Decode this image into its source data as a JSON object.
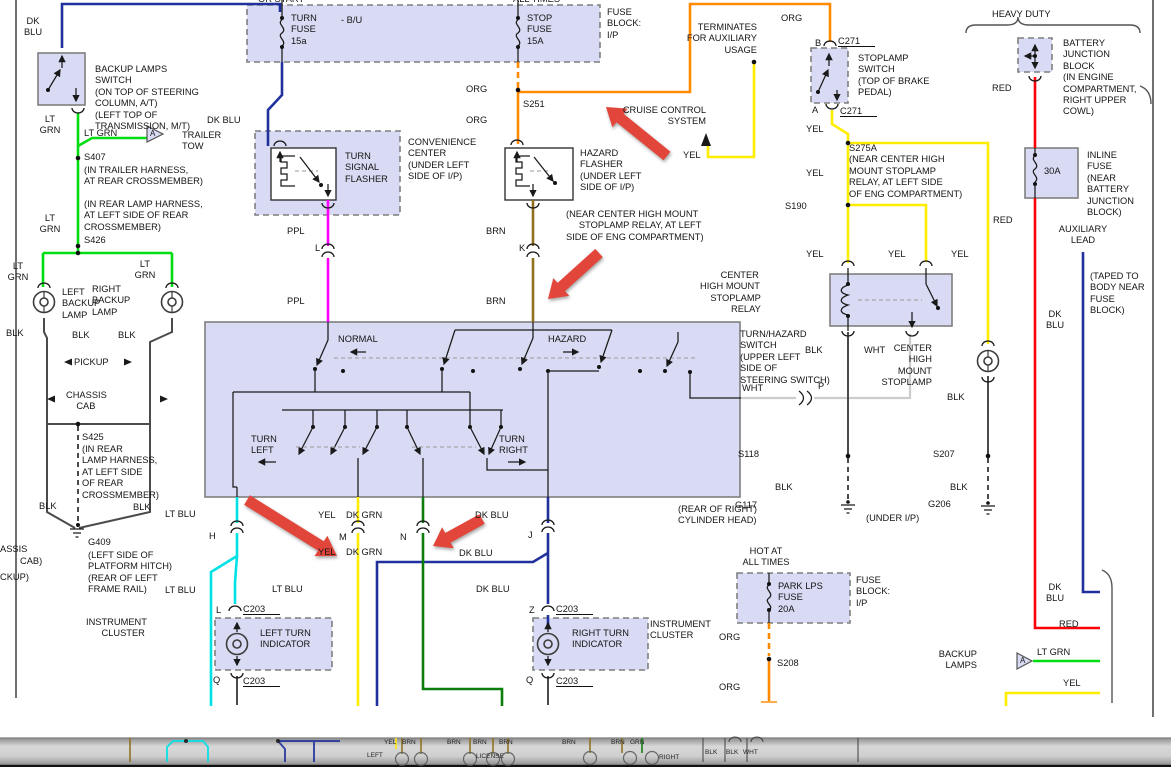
{
  "palette": {
    "dkblu": "#20309c",
    "ltgrn": "#00dd11",
    "org": "#ff8a00",
    "yel": "#ffed00",
    "ppl": "#ff00ff",
    "brn": "#8f701f",
    "ltblu": "#00e2e6",
    "dkgrn": "#0a7d0a",
    "red": "#fb0006",
    "blkwire": "#4b4b4b",
    "whtwire": "#cccccc",
    "lavender": "#d9daf3",
    "boxborder": "#7f7f7f",
    "arrowred": "#e2453a"
  },
  "labels": [
    {
      "n": "hot-in-run-fragment",
      "t": "OR START",
      "x": 258,
      "y": -6
    },
    {
      "n": "hot-at-all-times-fragment",
      "t": "ALL TIMES",
      "x": 513,
      "y": -6
    },
    {
      "n": "fuse-block-ip-label",
      "t": "FUSE\nBLOCK:\nI/P",
      "x": 607,
      "y": 7
    },
    {
      "n": "turn-fuse-label",
      "t": "TURN\nFUSE\n15a",
      "x": 291,
      "y": 13
    },
    {
      "n": "bu-tap-label",
      "t": "- B/U",
      "x": 341,
      "y": 15
    },
    {
      "n": "stop-fuse-label",
      "t": "STOP\nFUSE\n15A",
      "x": 527,
      "y": 13
    },
    {
      "n": "dk-blu-label-1",
      "t": "DK\nBLU",
      "x": 18,
      "y": 16,
      "w": 30,
      "al": "c"
    },
    {
      "n": "backup-lamps-switch-label",
      "t": "BACKUP LAMPS\nSWITCH\n(ON TOP OF STEERING\nCOLUMN, A/T)\n(LEFT TOP OF\nTRANSMISSION, M/T)",
      "x": 95,
      "y": 64
    },
    {
      "n": "lt-grn-label-1",
      "t": "LT\nGRN",
      "x": 32,
      "y": 114,
      "w": 36,
      "al": "c"
    },
    {
      "n": "lt-grn-label-2",
      "t": "LT GRN",
      "x": 84,
      "y": 128
    },
    {
      "n": "dk-blu-label-2",
      "t": "DK BLU",
      "x": 207,
      "y": 115
    },
    {
      "n": "trailer-tow-label",
      "t": "TRAILER\nTOW",
      "x": 182,
      "y": 130
    },
    {
      "n": "s407-label",
      "t": "S407",
      "x": 84,
      "y": 152
    },
    {
      "n": "s407-note",
      "t": "(IN TRAILER HARNESS,\nAT REAR CROSSMEMBER)",
      "x": 84,
      "y": 165
    },
    {
      "n": "s426-note",
      "t": "(IN REAR LAMP HARNESS,\nAT LEFT SIDE OF REAR\nCROSSMEMBER)",
      "x": 84,
      "y": 199
    },
    {
      "n": "lt-grn-label-3",
      "t": "LT\nGRN",
      "x": 32,
      "y": 213,
      "w": 36,
      "al": "c"
    },
    {
      "n": "s426-label",
      "t": "S426",
      "x": 84,
      "y": 235
    },
    {
      "n": "lt-grn-label-4",
      "t": "LT\nGRN",
      "x": 0,
      "y": 261,
      "w": 36,
      "al": "c"
    },
    {
      "n": "lt-grn-label-5",
      "t": "LT\nGRN",
      "x": 127,
      "y": 259,
      "w": 36,
      "al": "c"
    },
    {
      "n": "left-backup-lamp-label",
      "t": "LEFT\nBACKUP\nLAMP",
      "x": 62,
      "y": 287
    },
    {
      "n": "right-backup-lamp-label",
      "t": "RIGHT\nBACKUP\nLAMP",
      "x": 92,
      "y": 284
    },
    {
      "n": "blk-label-1",
      "t": "BLK",
      "x": 6,
      "y": 328
    },
    {
      "n": "blk-label-2",
      "t": "BLK",
      "x": 72,
      "y": 330
    },
    {
      "n": "blk-label-3",
      "t": "BLK",
      "x": 118,
      "y": 330
    },
    {
      "n": "pickup-label",
      "t": "PICKUP",
      "x": 74,
      "y": 357
    },
    {
      "n": "chassis-cab-label",
      "t": "CHASSIS\n    CAB",
      "x": 66,
      "y": 390
    },
    {
      "n": "s425-label",
      "t": "S425",
      "x": 82,
      "y": 432
    },
    {
      "n": "s425-note",
      "t": "(IN REAR\nLAMP HARNESS,\nAT LEFT SIDE\nOF REAR\nCROSSMEMBER)",
      "x": 82,
      "y": 444
    },
    {
      "n": "blk-label-4",
      "t": "BLK",
      "x": 39,
      "y": 501
    },
    {
      "n": "blk-label-5",
      "t": "BLK",
      "x": 133,
      "y": 502
    },
    {
      "n": "lt-blu-label-1",
      "t": "LT BLU",
      "x": 165,
      "y": 509
    },
    {
      "n": "chassis-fragment",
      "t": "ASSIS",
      "x": 0,
      "y": 544
    },
    {
      "n": "cab-fragment",
      "t": "CAB)",
      "x": 20,
      "y": 556
    },
    {
      "n": "pickup-fragment",
      "t": "CKUP)",
      "x": 0,
      "y": 572
    },
    {
      "n": "g409-label",
      "t": "G409",
      "x": 88,
      "y": 537
    },
    {
      "n": "g409-note",
      "t": "(LEFT SIDE OF\nPLATFORM HITCH)\n(REAR OF LEFT\nFRAME RAIL)",
      "x": 88,
      "y": 550
    },
    {
      "n": "lt-blu-label-2",
      "t": "LT BLU",
      "x": 165,
      "y": 585
    },
    {
      "n": "instrument-cluster-left-label",
      "t": "INSTRUMENT\n      CLUSTER",
      "x": 86,
      "y": 617
    },
    {
      "n": "convenience-center-label",
      "t": "CONVENIENCE\nCENTER\n(UNDER LEFT\nSIDE OF I/P)",
      "x": 408,
      "y": 137
    },
    {
      "n": "turn-signal-flasher-label",
      "t": "TURN\nSIGNAL\nFLASHER",
      "x": 345,
      "y": 151
    },
    {
      "n": "ppl-label-1",
      "t": "PPL",
      "x": 287,
      "y": 226
    },
    {
      "n": "connector-l-label",
      "t": "L",
      "x": 315,
      "y": 243
    },
    {
      "n": "ppl-label-2",
      "t": "PPL",
      "x": 287,
      "y": 296
    },
    {
      "n": "hazard-flasher-label",
      "t": "HAZARD\nFLASHER\n(UNDER LEFT\nSIDE OF I/P)",
      "x": 580,
      "y": 148
    },
    {
      "n": "brn-label-1",
      "t": "BRN",
      "x": 486,
      "y": 226
    },
    {
      "n": "connector-k-label",
      "t": "K",
      "x": 519,
      "y": 243
    },
    {
      "n": "brn-label-2",
      "t": "BRN",
      "x": 486,
      "y": 296
    },
    {
      "n": "chm-relay-location-note",
      "t": "(NEAR CENTER HIGH MOUNT\n     STOPLAMP RELAY, AT LEFT\nSIDE OF ENG COMPARTMENT)",
      "x": 566,
      "y": 209
    },
    {
      "n": "org-label-1",
      "t": "ORG",
      "x": 466,
      "y": 84
    },
    {
      "n": "s251-label",
      "t": "S251",
      "x": 523,
      "y": 99
    },
    {
      "n": "org-label-2",
      "t": "ORG",
      "x": 466,
      "y": 115
    },
    {
      "n": "cruise-control-label",
      "t": "CRUISE CONTROL\nSYSTEM",
      "x": 616,
      "y": 105,
      "w": 90,
      "al": "r"
    },
    {
      "n": "yel-label-cruise",
      "t": "YEL",
      "x": 683,
      "y": 150
    },
    {
      "n": "terminates-label",
      "t": "TERMINATES\nFOR AUXILIARY\nUSAGE",
      "x": 657,
      "y": 22,
      "w": 100,
      "al": "r"
    },
    {
      "n": "org-label-3",
      "t": "ORG",
      "x": 781,
      "y": 13
    },
    {
      "n": "connector-b-label",
      "t": "B",
      "x": 815,
      "y": 38
    },
    {
      "n": "c271-top-label",
      "t": "C271",
      "x": 838,
      "y": 36,
      "u": 1
    },
    {
      "n": "stoplamp-switch-label",
      "t": "STOPLAMP\nSWITCH\n(TOP OF BRAKE\nPEDAL)",
      "x": 858,
      "y": 53
    },
    {
      "n": "connector-a-label",
      "t": "A",
      "x": 812,
      "y": 105
    },
    {
      "n": "c271-bottom-label",
      "t": "C271",
      "x": 840,
      "y": 106,
      "u": 1
    },
    {
      "n": "yel-label-1",
      "t": "YEL",
      "x": 806,
      "y": 124
    },
    {
      "n": "s275a-label",
      "t": "S275A\n(NEAR CENTER HIGH\nMOUNT STOPLAMP\nRELAY, AT LEFT SIDE\nOF ENG COMPARTMENT)",
      "x": 849,
      "y": 143
    },
    {
      "n": "yel-label-2",
      "t": "YEL",
      "x": 806,
      "y": 168
    },
    {
      "n": "s190-label",
      "t": "S190",
      "x": 785,
      "y": 201
    },
    {
      "n": "yel-label-3",
      "t": "YEL",
      "x": 806,
      "y": 249
    },
    {
      "n": "yel-label-4",
      "t": "YEL",
      "x": 888,
      "y": 249
    },
    {
      "n": "yel-label-5",
      "t": "YEL",
      "x": 951,
      "y": 249
    },
    {
      "n": "chm-relay-label",
      "t": "        CENTER\nHIGH MOUNT\n    STOPLAMP\n            RELAY",
      "x": 700,
      "y": 270
    },
    {
      "n": "turn-hazard-switch-label",
      "t": "TURN/HAZARD\nSWITCH\n(UPPER LEFT\nSIDE OF\nSTEERING SWITCH)",
      "x": 740,
      "y": 329
    },
    {
      "n": "blk-label-6",
      "t": "BLK",
      "x": 805,
      "y": 345
    },
    {
      "n": "wht-label-1",
      "t": "WHT",
      "x": 864,
      "y": 345
    },
    {
      "n": "chm-stoplamp-label",
      "t": "CENTER\nHIGH\nMOUNT\nSTOPLAMP",
      "x": 840,
      "y": 343,
      "w": 92,
      "al": "r"
    },
    {
      "n": "wht-label-2",
      "t": "WHT",
      "x": 742,
      "y": 383
    },
    {
      "n": "connector-p-label",
      "t": "P",
      "x": 818,
      "y": 381
    },
    {
      "n": "blk-label-7",
      "t": "BLK",
      "x": 947,
      "y": 392
    },
    {
      "n": "s118-label",
      "t": "S118",
      "x": 738,
      "y": 449
    },
    {
      "n": "s207-label",
      "t": "S207",
      "x": 933,
      "y": 449
    },
    {
      "n": "blk-label-8",
      "t": "BLK",
      "x": 775,
      "y": 482
    },
    {
      "n": "blk-label-9",
      "t": "BLK",
      "x": 950,
      "y": 482
    },
    {
      "n": "g117-label",
      "t": "G117",
      "x": 735,
      "y": 500
    },
    {
      "n": "g206-label",
      "t": "G206",
      "x": 928,
      "y": 499
    },
    {
      "n": "under-ip-note",
      "t": "(UNDER I/P)",
      "x": 866,
      "y": 513
    },
    {
      "n": "rear-cylinder-note",
      "t": "(REAR OF RIGHT)\nCYLINDER HEAD)",
      "x": 678,
      "y": 504
    },
    {
      "n": "heavy-duty-label",
      "t": "HEAVY DUTY",
      "x": 992,
      "y": 9
    },
    {
      "n": "battery-junction-label",
      "t": "BATTERY\nJUNCTION\nBLOCK\n(IN ENGINE\nCOMPARTMENT,\nRIGHT UPPER\nCOWL)",
      "x": 1063,
      "y": 38
    },
    {
      "n": "red-label-1",
      "t": "RED",
      "x": 992,
      "y": 83
    },
    {
      "n": "inline-fuse-label",
      "t": "INLINE\nFUSE\n(NEAR\nBATTERY\nJUNCTION\nBLOCK)",
      "x": 1087,
      "y": 150
    },
    {
      "n": "fuse-30a-label",
      "t": "30A",
      "x": 1044,
      "y": 166
    },
    {
      "n": "red-label-2",
      "t": "RED",
      "x": 993,
      "y": 215
    },
    {
      "n": "auxiliary-lead-label",
      "t": "AUXILIARY\nLEAD",
      "x": 1052,
      "y": 224,
      "w": 62,
      "al": "c"
    },
    {
      "n": "taped-note",
      "t": "(TAPED TO\nBODY NEAR\nFUSE\nBLOCK)",
      "x": 1090,
      "y": 271
    },
    {
      "n": "dk-blu-label-3",
      "t": "DK\nBLU",
      "x": 1040,
      "y": 309,
      "w": 30,
      "al": "c"
    },
    {
      "n": "dk-blu-label-4",
      "t": "DK\nBLU",
      "x": 1040,
      "y": 582,
      "w": 30,
      "al": "c"
    },
    {
      "n": "red-label-3",
      "t": "RED",
      "x": 1059,
      "y": 619
    },
    {
      "n": "backup-lamps-label",
      "t": "BACKUP\nLAMPS",
      "x": 905,
      "y": 649,
      "w": 72,
      "al": "r"
    },
    {
      "n": "lt-grn-label-6",
      "t": "LT GRN",
      "x": 1037,
      "y": 647
    },
    {
      "n": "yel-label-6",
      "t": "YEL",
      "x": 1063,
      "y": 678
    },
    {
      "n": "normal-label",
      "t": "NORMAL",
      "x": 338,
      "y": 334
    },
    {
      "n": "hazard-label",
      "t": "HAZARD",
      "x": 548,
      "y": 334
    },
    {
      "n": "turn-left-label",
      "t": "TURN\nLEFT",
      "x": 251,
      "y": 434
    },
    {
      "n": "turn-right-label",
      "t": "TURN\nRIGHT",
      "x": 499,
      "y": 434
    },
    {
      "n": "yel-label-7",
      "t": "YEL",
      "x": 318,
      "y": 510
    },
    {
      "n": "dk-grn-label-1",
      "t": "DK GRN",
      "x": 346,
      "y": 510
    },
    {
      "n": "dk-blu-label-5",
      "t": "DK BLU",
      "x": 475,
      "y": 510
    },
    {
      "n": "connector-h-label",
      "t": "H",
      "x": 209,
      "y": 531
    },
    {
      "n": "connector-m-label",
      "t": "M",
      "x": 339,
      "y": 532
    },
    {
      "n": "connector-n-label",
      "t": "N",
      "x": 400,
      "y": 532
    },
    {
      "n": "connector-j-label",
      "t": "J",
      "x": 528,
      "y": 530
    },
    {
      "n": "yel-label-8",
      "t": "YEL",
      "x": 318,
      "y": 547
    },
    {
      "n": "dk-grn-label-2",
      "t": "DK GRN",
      "x": 346,
      "y": 547
    },
    {
      "n": "dk-blu-label-6",
      "t": "DK BLU",
      "x": 459,
      "y": 548
    },
    {
      "n": "lt-blu-label-3",
      "t": "LT BLU",
      "x": 272,
      "y": 584
    },
    {
      "n": "dk-blu-label-7",
      "t": "DK BLU",
      "x": 476,
      "y": 584
    },
    {
      "n": "connector-l2-label",
      "t": "L",
      "x": 216,
      "y": 605
    },
    {
      "n": "c203-label-1",
      "t": "C203",
      "x": 243,
      "y": 604,
      "u": 1
    },
    {
      "n": "left-turn-indicator-label",
      "t": "LEFT TURN\nINDICATOR",
      "x": 260,
      "y": 628
    },
    {
      "n": "connector-q1-label",
      "t": "Q",
      "x": 213,
      "y": 675
    },
    {
      "n": "c203-label-2",
      "t": "C203",
      "x": 243,
      "y": 676,
      "u": 1
    },
    {
      "n": "connector-z-label",
      "t": "Z",
      "x": 529,
      "y": 605
    },
    {
      "n": "c203-label-3",
      "t": "C203",
      "x": 556,
      "y": 604,
      "u": 1
    },
    {
      "n": "right-turn-indicator-label",
      "t": "RIGHT TURN\nINDICATOR",
      "x": 572,
      "y": 628
    },
    {
      "n": "connector-q2-label",
      "t": "Q",
      "x": 526,
      "y": 675
    },
    {
      "n": "c203-label-4",
      "t": "C203",
      "x": 556,
      "y": 676,
      "u": 1
    },
    {
      "n": "instrument-cluster-right-label",
      "t": "INSTRUMENT\nCLUSTER",
      "x": 650,
      "y": 619
    },
    {
      "n": "hot-at-all-times-label",
      "t": "HOT AT\nALL TIMES",
      "x": 735,
      "y": 546,
      "w": 62,
      "al": "c"
    },
    {
      "n": "park-lps-fuse-label",
      "t": "PARK LPS\nFUSE\n20A",
      "x": 778,
      "y": 581
    },
    {
      "n": "fuse-block-ip-label-2",
      "t": "FUSE\nBLOCK:\nI/P",
      "x": 856,
      "y": 575
    },
    {
      "n": "org-label-4",
      "t": "ORG",
      "x": 719,
      "y": 632
    },
    {
      "n": "s208-label",
      "t": "S208",
      "x": 777,
      "y": 658
    },
    {
      "n": "org-label-5",
      "t": "ORG",
      "x": 719,
      "y": 682
    },
    {
      "n": "trailer-tow-a-glyph",
      "t": "A",
      "x": 150,
      "y": 128,
      "cls": "tri"
    },
    {
      "n": "backup-lamps-a-glyph",
      "t": "A",
      "x": 1020,
      "y": 655,
      "cls": "tri"
    },
    {
      "n": "bar-yel-label",
      "t": "YEL",
      "x": 384,
      "y": 739,
      "cls": "bar"
    },
    {
      "n": "bar-brn-label-1",
      "t": "BRN",
      "x": 402,
      "y": 739,
      "cls": "bar"
    },
    {
      "n": "bar-brn-label-2",
      "t": "BRN",
      "x": 447,
      "y": 739,
      "cls": "bar"
    },
    {
      "n": "bar-brn-label-3",
      "t": "BRN",
      "x": 473,
      "y": 739,
      "cls": "bar"
    },
    {
      "n": "bar-brn-label-4",
      "t": "BRN",
      "x": 499,
      "y": 739,
      "cls": "bar"
    },
    {
      "n": "bar-brn-label-5",
      "t": "BRN",
      "x": 562,
      "y": 739,
      "cls": "bar"
    },
    {
      "n": "bar-brn-label-6",
      "t": "BRN",
      "x": 611,
      "y": 739,
      "cls": "bar"
    },
    {
      "n": "bar-grn-label",
      "t": "GRN",
      "x": 630,
      "y": 739,
      "cls": "bar"
    },
    {
      "n": "bar-left-label",
      "t": "LEFT",
      "x": 367,
      "y": 752,
      "cls": "bar"
    },
    {
      "n": "bar-license-label",
      "t": "LICENSE",
      "x": 476,
      "y": 753,
      "cls": "bar"
    },
    {
      "n": "bar-right-label",
      "t": "RIGHT",
      "x": 659,
      "y": 754,
      "cls": "bar"
    },
    {
      "n": "bar-blk-label-1",
      "t": "BLK",
      "x": 705,
      "y": 749,
      "cls": "bar"
    },
    {
      "n": "bar-blk-label-2",
      "t": "BLK",
      "x": 726,
      "y": 749,
      "cls": "bar"
    },
    {
      "n": "bar-wht-label",
      "t": "WHT",
      "x": 743,
      "y": 749,
      "cls": "bar"
    }
  ]
}
